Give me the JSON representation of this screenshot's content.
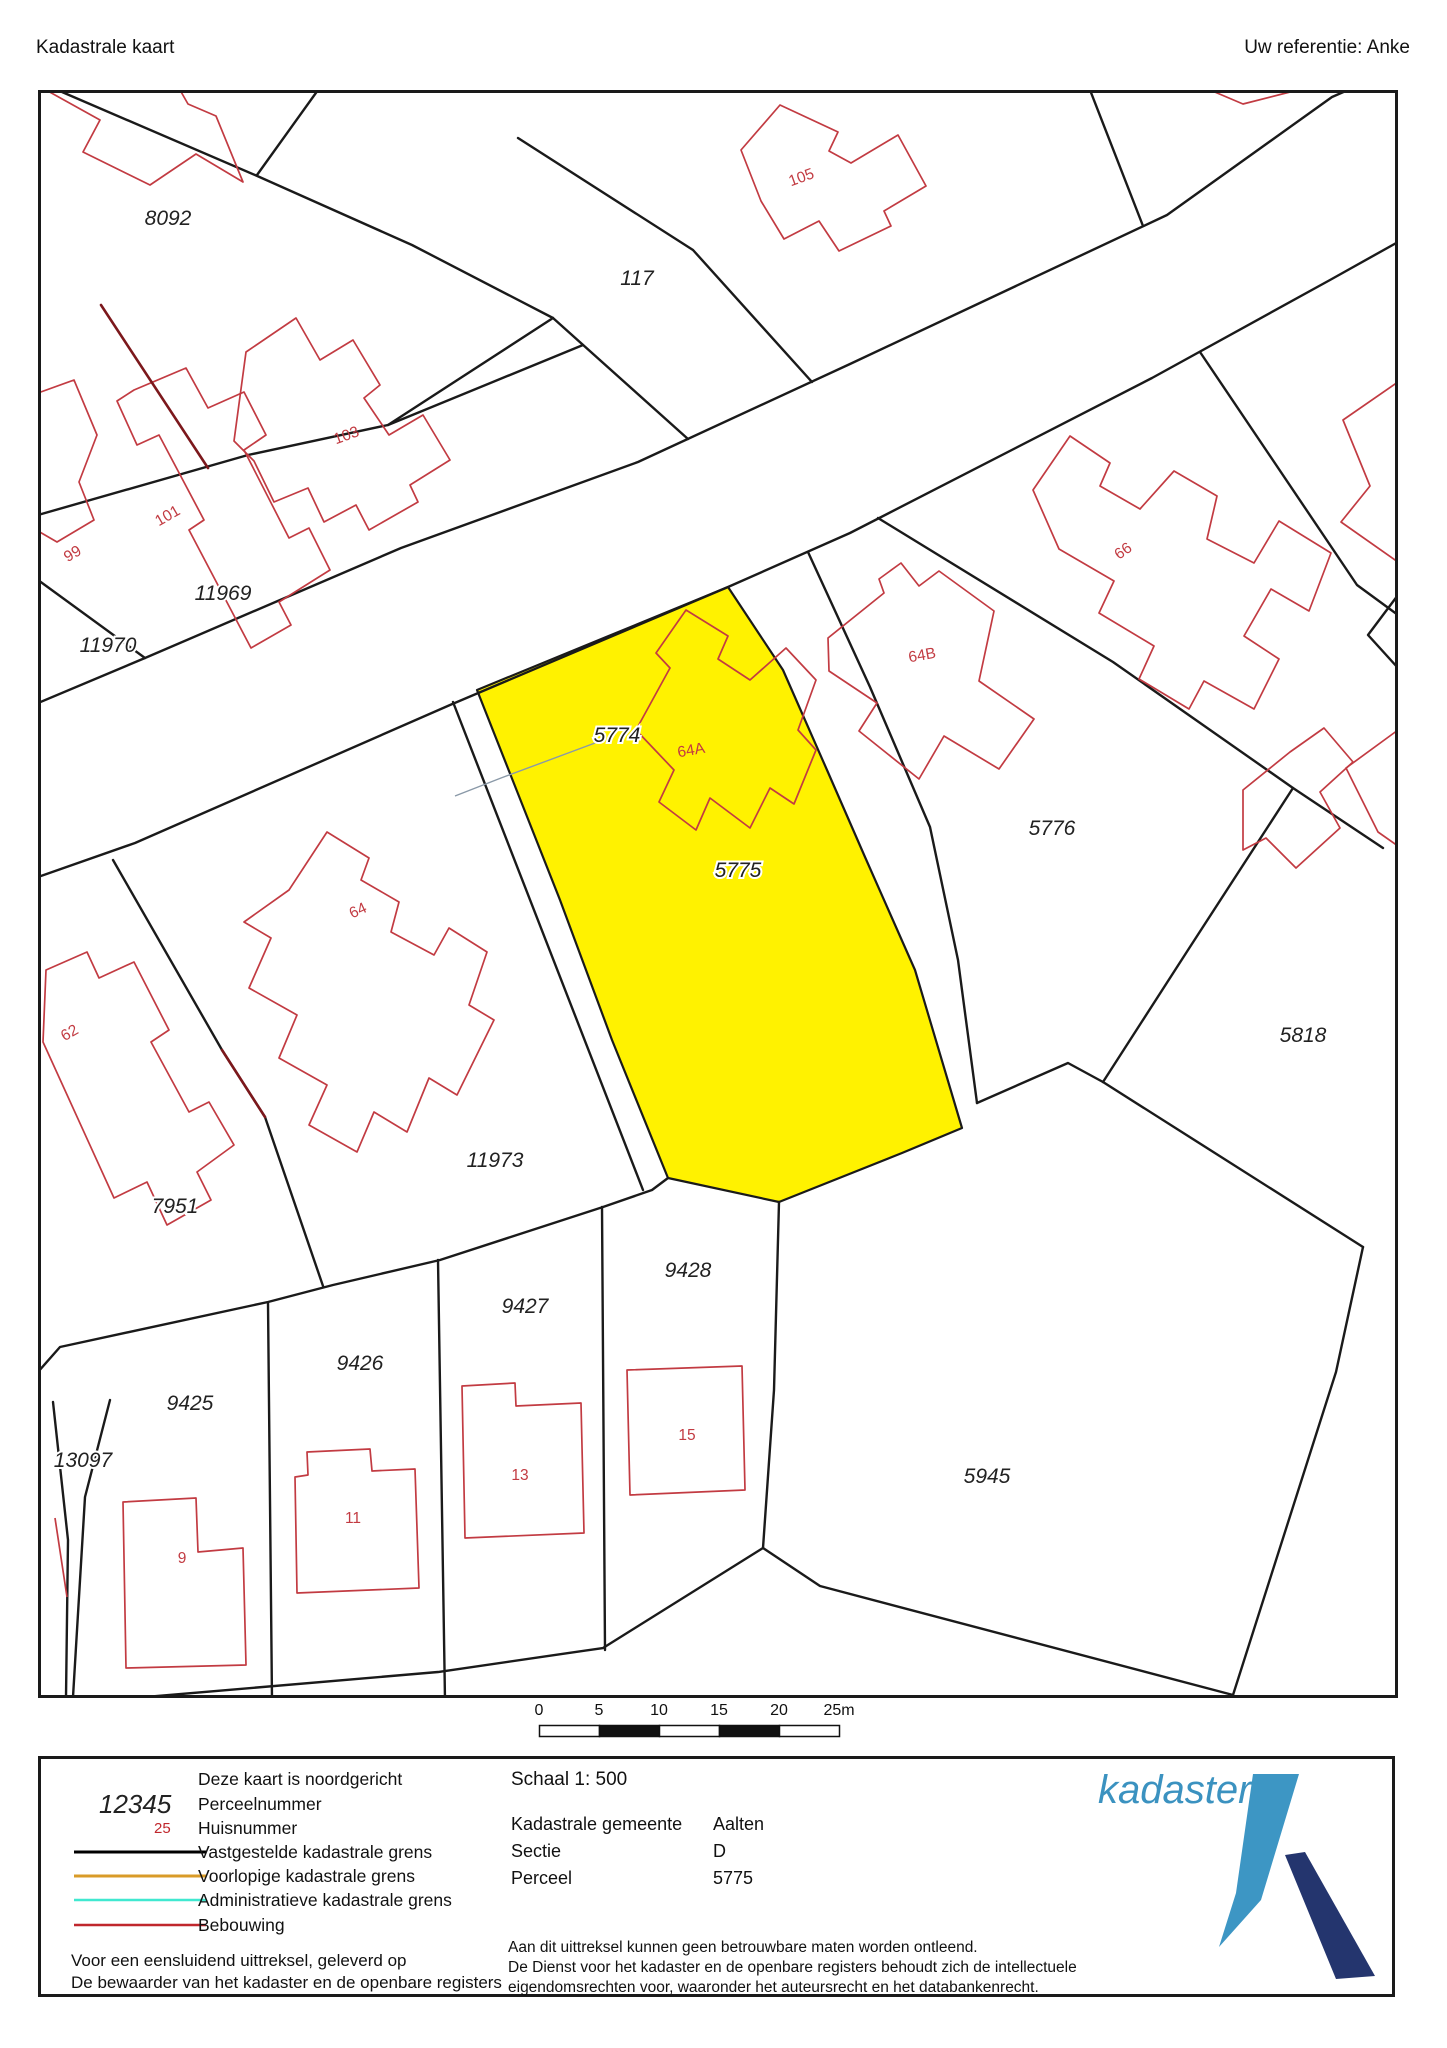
{
  "header": {
    "title": "Kadastrale kaart",
    "reference": "Uw referentie: Anke"
  },
  "map": {
    "highlight_color": "#fff200",
    "highlighted_parcel": "5775",
    "boundary_color": "#1a1a1a",
    "building_color": "#c23b42",
    "parcel_labels": [
      {
        "text": "8092",
        "x": 130,
        "y": 135
      },
      {
        "text": "117",
        "x": 599,
        "y": 195
      },
      {
        "text": "11969",
        "x": 185,
        "y": 510
      },
      {
        "text": "11970",
        "x": 70,
        "y": 562
      },
      {
        "text": "5774",
        "x": 579,
        "y": 652
      },
      {
        "text": "5775",
        "x": 700,
        "y": 787
      },
      {
        "text": "5776",
        "x": 1014,
        "y": 745
      },
      {
        "text": "5818",
        "x": 1265,
        "y": 952
      },
      {
        "text": "11973",
        "x": 457,
        "y": 1077
      },
      {
        "text": "7951",
        "x": 137,
        "y": 1123
      },
      {
        "text": "9428",
        "x": 650,
        "y": 1187
      },
      {
        "text": "9427",
        "x": 487,
        "y": 1223
      },
      {
        "text": "9426",
        "x": 322,
        "y": 1280
      },
      {
        "text": "9425",
        "x": 152,
        "y": 1320
      },
      {
        "text": "13097",
        "x": 45,
        "y": 1377
      },
      {
        "text": "5945",
        "x": 949,
        "y": 1393
      }
    ],
    "house_numbers": [
      {
        "text": "105",
        "x": 765,
        "y": 92,
        "rot": -20
      },
      {
        "text": "103",
        "x": 310,
        "y": 350,
        "rot": -20
      },
      {
        "text": "101",
        "x": 132,
        "y": 430,
        "rot": -30
      },
      {
        "text": "99",
        "x": 37,
        "y": 468,
        "rot": -30
      },
      {
        "text": "66",
        "x": 1088,
        "y": 465,
        "rot": -35
      },
      {
        "text": "64B",
        "x": 885,
        "y": 570,
        "rot": -10
      },
      {
        "text": "64A",
        "x": 654,
        "y": 665,
        "rot": -10
      },
      {
        "text": "64",
        "x": 322,
        "y": 825,
        "rot": -25
      },
      {
        "text": "62",
        "x": 34,
        "y": 947,
        "rot": -30
      },
      {
        "text": "9",
        "x": 144,
        "y": 1473,
        "rot": 0
      },
      {
        "text": "11",
        "x": 315,
        "y": 1433,
        "rot": 0
      },
      {
        "text": "13",
        "x": 482,
        "y": 1390,
        "rot": 0
      },
      {
        "text": "15",
        "x": 649,
        "y": 1350,
        "rot": 0
      }
    ]
  },
  "scale_bar": {
    "ticks": [
      "0",
      "5",
      "10",
      "15",
      "20",
      "25m"
    ]
  },
  "legend": {
    "north_note": "Deze kaart is noordgericht",
    "items": [
      {
        "sample": "12345",
        "label": "Perceelnummer"
      },
      {
        "sample": "25",
        "label": "Huisnummer"
      },
      {
        "color": "#000000",
        "label": "Vastgestelde kadastrale grens"
      },
      {
        "color": "#d99b28",
        "label": "Voorlopige kadastrale grens"
      },
      {
        "color": "#40e8d0",
        "label": "Administratieve kadastrale grens"
      },
      {
        "color": "#c0272d",
        "label": "Bebouwing"
      }
    ],
    "footer_line1": "Voor een eensluidend uittreksel, geleverd op",
    "footer_line2": "De bewaarder van het kadaster en de openbare registers"
  },
  "info": {
    "scale": "Schaal 1: 500",
    "rows": [
      {
        "label": "Kadastrale gemeente",
        "value": "Aalten"
      },
      {
        "label": "Sectie",
        "value": "D"
      },
      {
        "label": "Perceel",
        "value": "5775"
      }
    ],
    "disclaimer": [
      "Aan dit uittreksel kunnen geen betrouwbare maten worden ontleend.",
      "De Dienst voor het kadaster en de openbare registers behoudt zich de intellectuele",
      "eigendomsrechten voor, waaronder het auteursrecht en het databankenrecht."
    ]
  },
  "logo": {
    "text": "kadaster",
    "text_color": "#3b92c0",
    "mark_light": "#3d96c4",
    "mark_dark": "#24356e"
  }
}
